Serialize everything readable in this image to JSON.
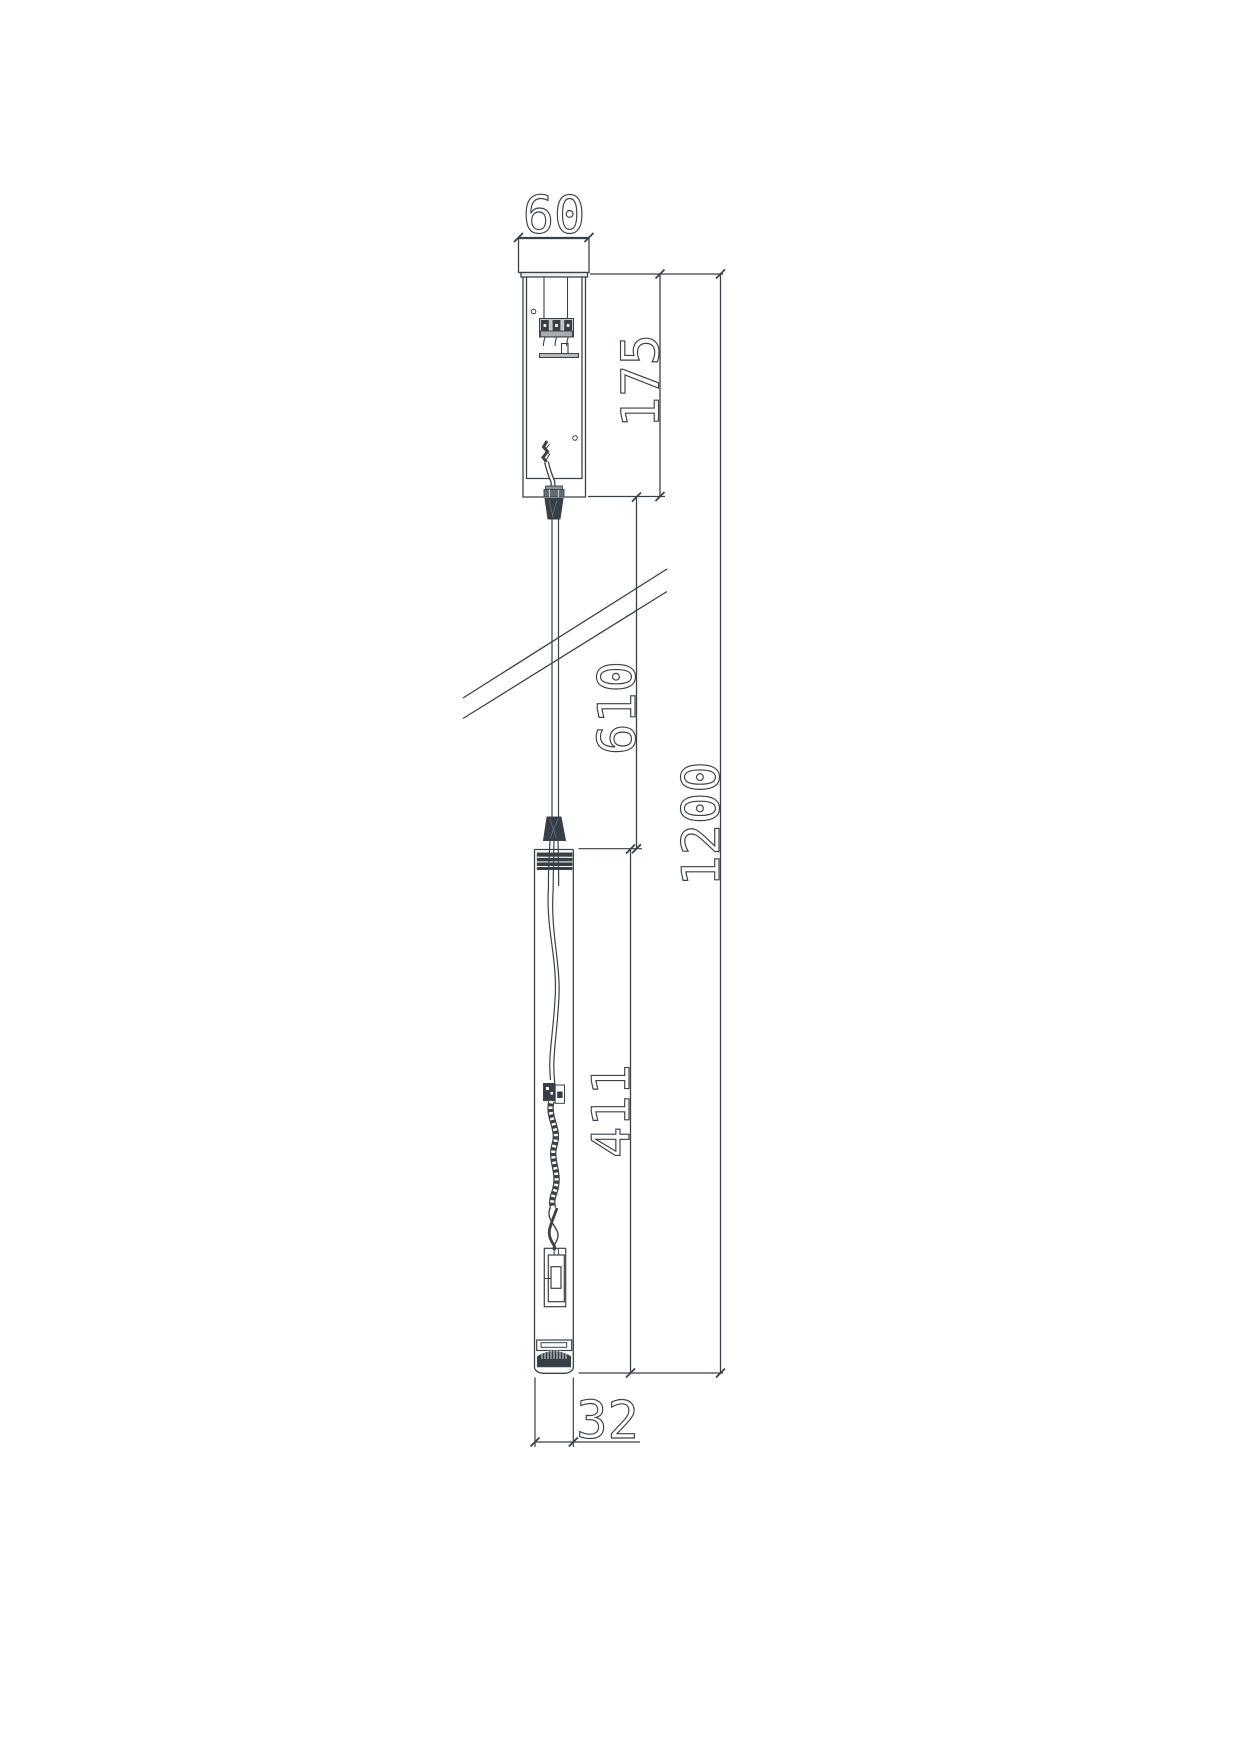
{
  "page": {
    "background": "#ffffff",
    "line_color": "#3a4147",
    "dark_fill": "#383e45",
    "gray_fill": "#b9bdc0"
  },
  "drawing": {
    "type": "technical-dimension-drawing",
    "subject": "pendant-luminaire-side-view",
    "units": "mm",
    "dimensions": {
      "canopy_width": "60",
      "canopy_height": "175",
      "suspension_drop": "610",
      "overall_height": "1200",
      "lamp_body_length": "411",
      "lamp_body_width": "32"
    }
  }
}
